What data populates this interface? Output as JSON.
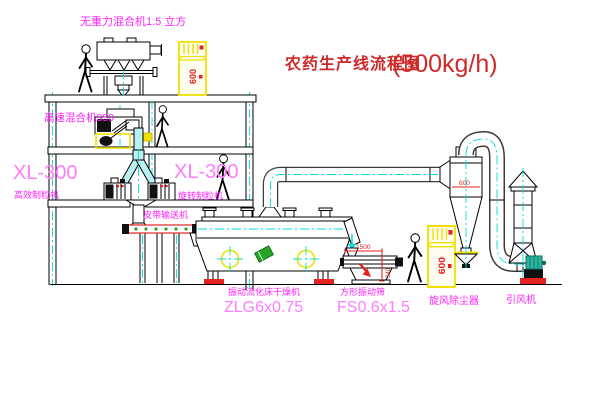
{
  "diagram": {
    "title_text": "农药生产线流程图",
    "title_capacity": "(500kg/h)",
    "labels": {
      "top_mixer": "无重力混合机1.5 立方",
      "high_speed_mixer": "高速混合机350",
      "granulator_left_model": "XL-300",
      "granulator_left_name": "高效制粒机",
      "granulator_mid_model": "XL-300",
      "granulator_mid_name": "旋转制粒机",
      "belt_conveyor": "皮带输送机",
      "dryer_name": "振动流化床干燥机",
      "dryer_model": "ZLG6x0.75",
      "screen_name": "方形振动筛",
      "screen_model": "FS0.6x1.5",
      "cyclone": "旋风除尘器",
      "fan": "引风机"
    },
    "dims": {
      "screen_length": "1500",
      "screen_height": "340",
      "cyclone": "600",
      "cabinet": "600"
    },
    "colors": {
      "background": "#ffffff",
      "line": "#000000",
      "centerline_cyan": "#00dede",
      "label_magenta": "#ff22ff",
      "label_magenta_light": "#ff7dff",
      "title_red": "#cf2a2a",
      "equipment_yellow": "#f0e000",
      "alarm_red": "#e32222",
      "duct_cyan_fill": "#baf0f2",
      "motor_teal": "#2bb5a0",
      "roller_green": "#27a527"
    }
  }
}
